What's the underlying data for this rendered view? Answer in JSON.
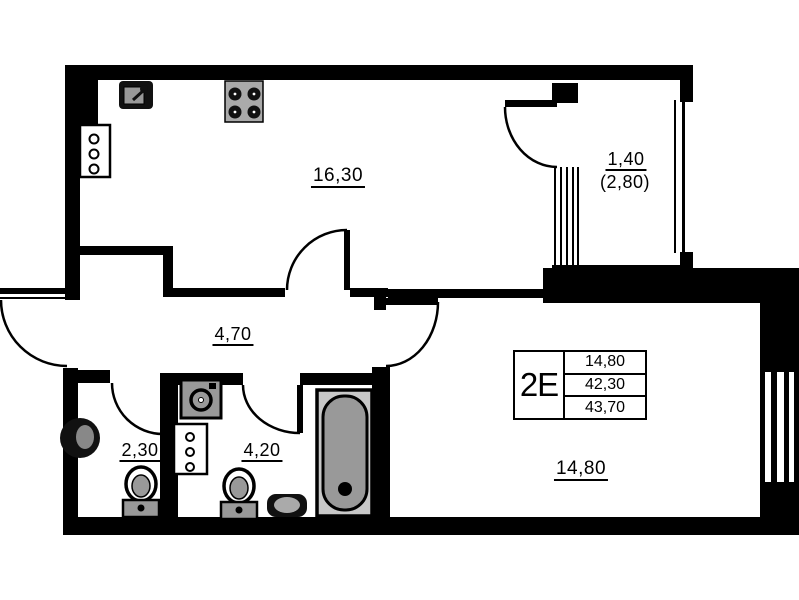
{
  "plan": {
    "type": "apartment floor plan",
    "unit": {
      "code": "2E",
      "row1": "14,80",
      "row2": "42,30",
      "row3": "43,70"
    },
    "rooms": {
      "kitchen_living": "16,30",
      "hallway": "4,70",
      "wc": "2,30",
      "bathroom": "4,20",
      "bedroom": "14,80",
      "balcony": "1,40",
      "balcony_total": "(2,80)"
    },
    "colors": {
      "wall": "#000000",
      "fixture_dark": "#111111",
      "fixture_gray": "#999999",
      "fixture_light": "#c8c8c8",
      "background": "#ffffff"
    }
  }
}
